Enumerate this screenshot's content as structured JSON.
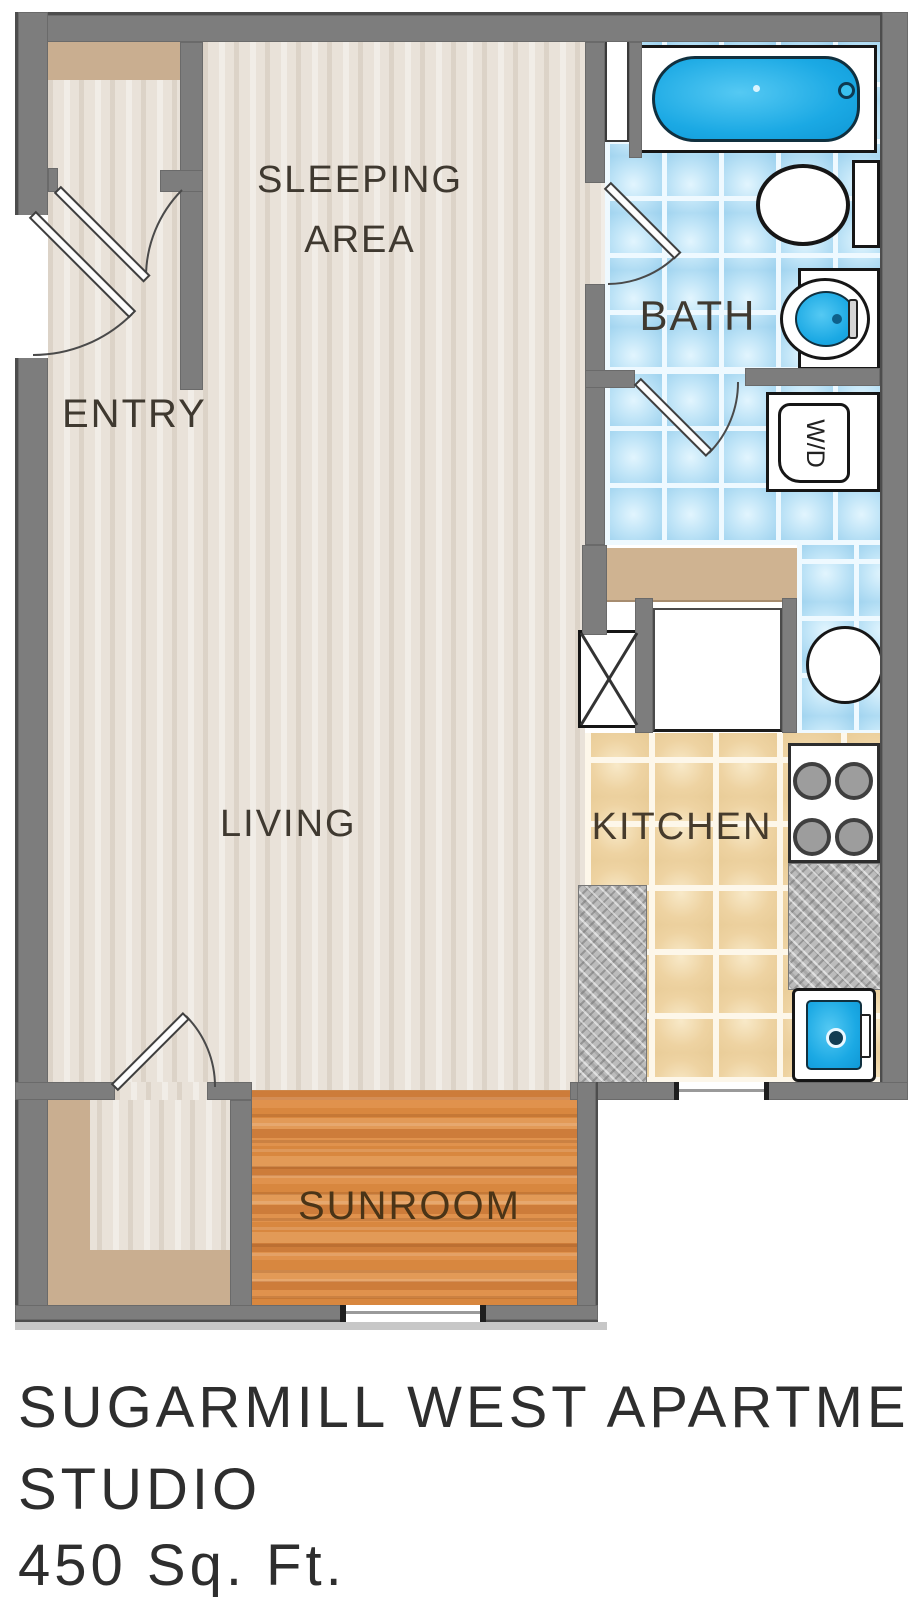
{
  "title": "Sugarmill West Apartments Studio Floor Plan",
  "labels": {
    "sleeping_line1": "SLEEPING",
    "sleeping_line2": "AREA",
    "entry": "ENTRY",
    "bath": "BATH",
    "living": "LIVING",
    "kitchen": "KITCHEN",
    "sunroom": "SUNROOM"
  },
  "fixtures": {
    "washer_dryer_label": "W/D"
  },
  "caption": {
    "line1": "SUGARMILL WEST APARTMENTS",
    "line2": "STUDIO",
    "line3": "450 Sq. Ft."
  },
  "colors": {
    "wall_gray": "#7d7d7d",
    "floor_beige": "#e9e2d9",
    "shelf_tan": "#c9ae90",
    "bath_tile_blue": "#bfe4f7",
    "kitchen_tile_tan": "#efd6a6",
    "sunroom_wood": "#d8873f",
    "fixture_blue": "#1fade6",
    "counter_gray": "#bcbcbc",
    "label_text": "#3f3930"
  }
}
